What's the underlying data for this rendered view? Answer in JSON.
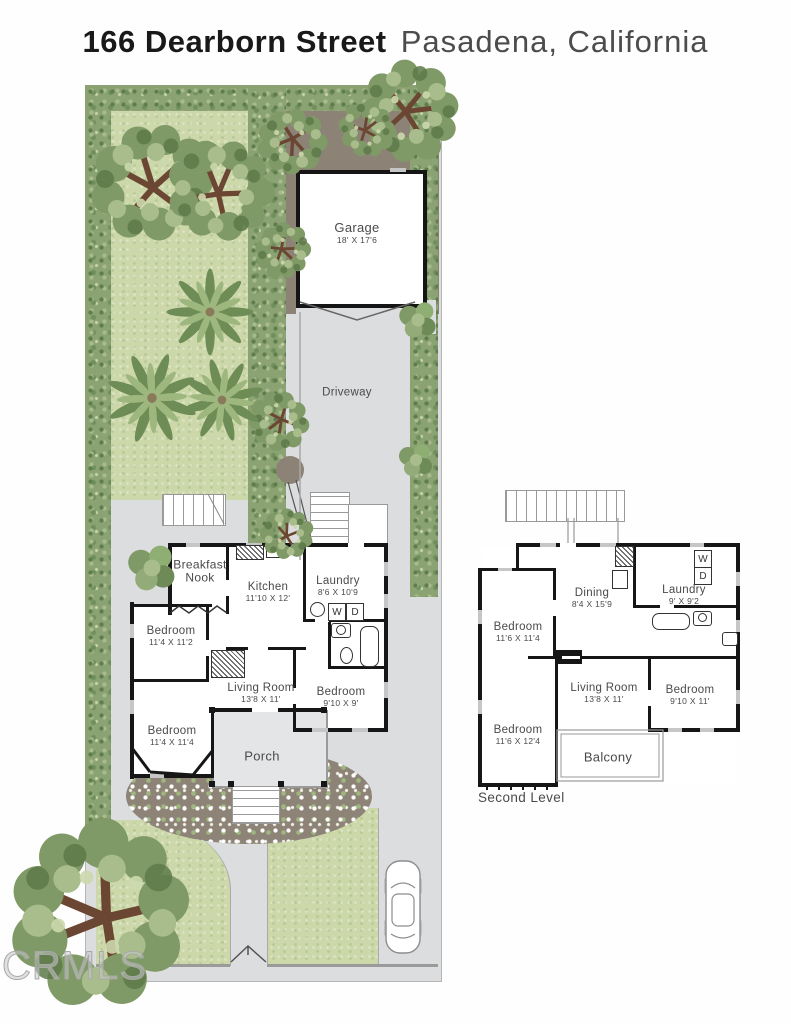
{
  "title": {
    "address": "166 Dearborn Street",
    "city": "Pasadena, California"
  },
  "site": {
    "garage": {
      "name": "Garage",
      "dims": "18' X 17'6"
    },
    "driveway": {
      "label": "Driveway"
    }
  },
  "first_floor": {
    "rooms": [
      {
        "name": "Breakfast Nook",
        "dims": ""
      },
      {
        "name": "Kitchen",
        "dims": "11'10 X 12'"
      },
      {
        "name": "Laundry",
        "dims": "8'6 X 10'9"
      },
      {
        "name": "Bedroom",
        "dims": "11'4 X 11'2"
      },
      {
        "name": "Living Room",
        "dims": "13'8 X 11'"
      },
      {
        "name": "Bedroom",
        "dims": "9'10 X 9'"
      },
      {
        "name": "Bedroom",
        "dims": "11'4 X 11'4"
      },
      {
        "name": "Porch",
        "dims": ""
      }
    ],
    "appliances": {
      "washer": "W",
      "dryer": "D"
    }
  },
  "second_level": {
    "label": "Second Level",
    "rooms": [
      {
        "name": "Dining",
        "dims": "8'4 X 15'9"
      },
      {
        "name": "Laundry",
        "dims": "9' X 9'2"
      },
      {
        "name": "Bedroom",
        "dims": "11'6 X 11'4"
      },
      {
        "name": "Living Room",
        "dims": "13'8 X 11'"
      },
      {
        "name": "Bedroom",
        "dims": "9'10 X 11'"
      },
      {
        "name": "Bedroom",
        "dims": "11'6 X 12'4"
      },
      {
        "name": "Balcony",
        "dims": ""
      }
    ],
    "appliances": {
      "washer": "W",
      "dryer": "D"
    }
  },
  "watermark": "CRMLS",
  "colors": {
    "lawn": "#ccd8a9",
    "hedge": "#8ba272",
    "concrete": "#dcdddf",
    "soil": "#8c8276",
    "wall": "#161616",
    "label_text": "#4a4a4a"
  }
}
